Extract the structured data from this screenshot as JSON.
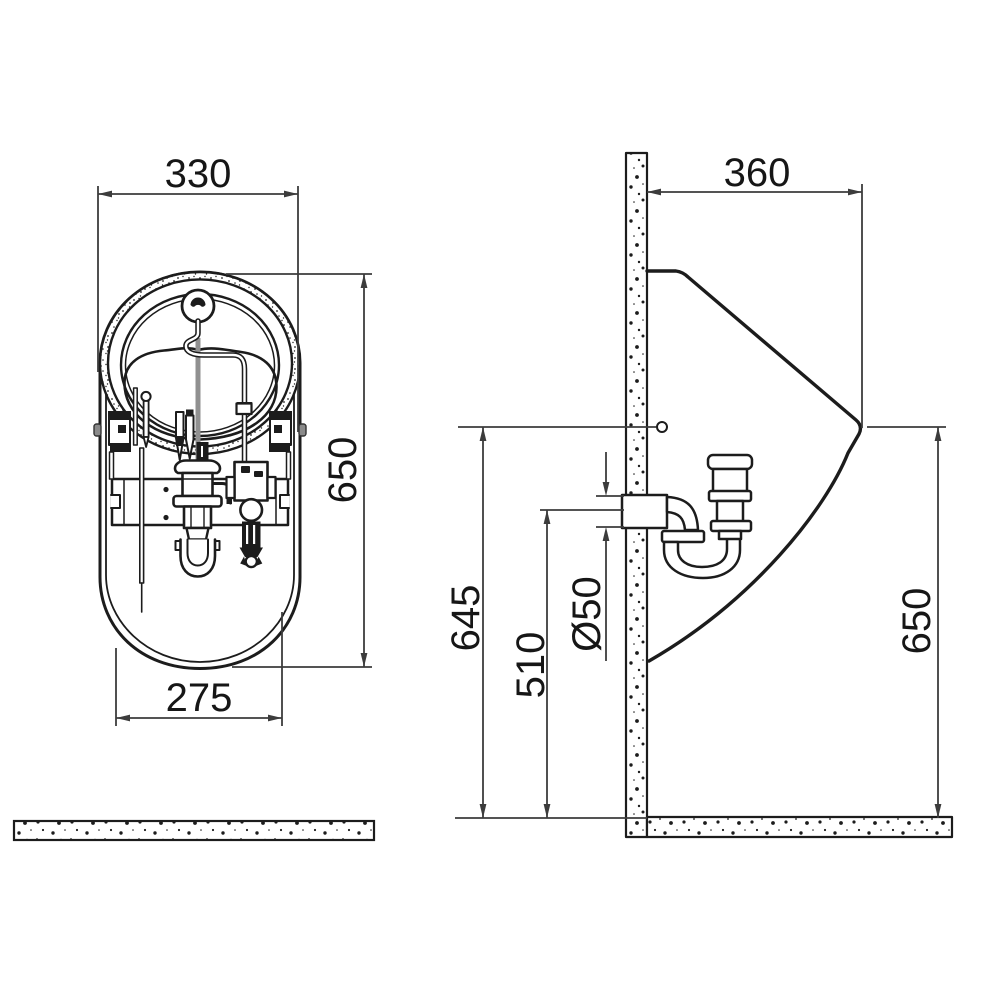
{
  "drawing": {
    "type": "technical installation drawing",
    "subject": "wall-hung urinal with flush valve and siphon, front view and side view",
    "background_color": "#ffffff",
    "object_line_color": "#1c1c1c",
    "dimension_line_color": "#3c3c3c",
    "front_view": {
      "name": "front-view",
      "dim_overall_width": "330",
      "dim_overall_height": "650",
      "dim_bottom_width": "275"
    },
    "side_view": {
      "name": "side-view",
      "dim_depth_from_wall": "360",
      "dim_fixing_hole_height": "645",
      "dim_outlet_center_height": "510",
      "dim_outlet_diameter": "Ø50",
      "dim_rim_front_height": "650"
    }
  }
}
